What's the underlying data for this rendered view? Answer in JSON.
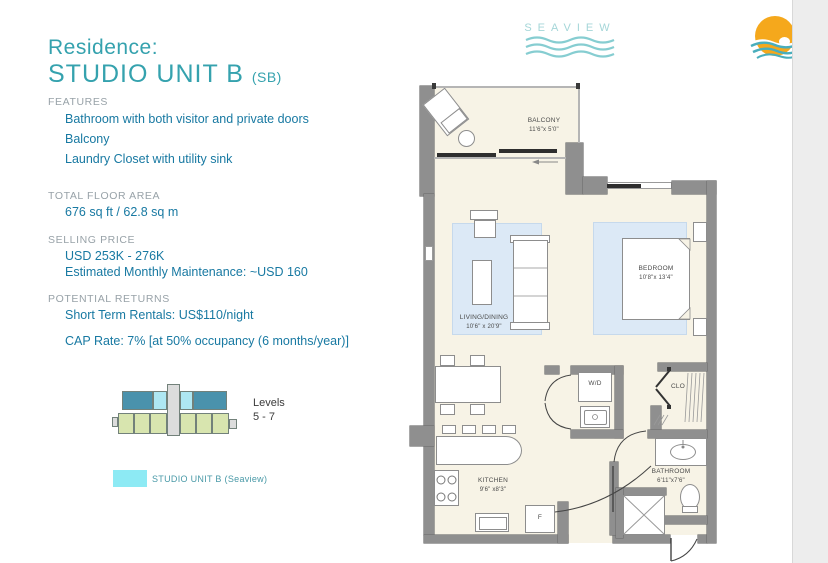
{
  "brand": {
    "wordmark": "SEAVIEW"
  },
  "panel": {
    "residence": "Residence:",
    "unit_name": "STUDIO UNIT B",
    "unit_code": "(SB)",
    "features": {
      "heading": "FEATURES",
      "items": [
        "Bathroom with both visitor and private doors",
        "Balcony",
        "Laundry Closet with utility sink"
      ]
    },
    "floor_area": {
      "heading": "TOTAL FLOOR AREA",
      "value": "676 sq ft / 62.8 sq m"
    },
    "price": {
      "heading": "SELLING PRICE",
      "range": "USD 253K - 276K",
      "maintenance": "Estimated Monthly Maintenance: ~USD 160"
    },
    "returns": {
      "heading": "POTENTIAL RETURNS",
      "rental": "Short Term Rentals: US$110/night",
      "cap_rate": "CAP Rate: 7% [at 50% occupancy (6 months/year)]"
    },
    "levels": {
      "label": "Levels",
      "range": "5 - 7"
    },
    "legend": {
      "label": "STUDIO UNIT B (Seaview)"
    }
  },
  "floorplan": {
    "balcony": {
      "name": "BALCONY",
      "dims": "11'6\"x 5'0\""
    },
    "living": {
      "name": "LIVING/DINING",
      "dims": "10'6\" x 20'9\""
    },
    "bedroom": {
      "name": "BEDROOM",
      "dims": "10'8\"x 13'4\""
    },
    "kitchen": {
      "name": "KITCHEN",
      "dims": "9'6\" x8'3\""
    },
    "bathroom": {
      "name": "BATHROOM",
      "dims": "6'11\"x7'6\""
    },
    "laundry": {
      "label": "W/D"
    },
    "closet": {
      "label": "CLO"
    },
    "fridge": {
      "label": "F"
    }
  },
  "colors": {
    "accent_teal": "#35a2ae",
    "body_teal": "#1879a2",
    "heading_gray": "#98a2a8",
    "legend_swatch": "#8deaf4",
    "building_dark_teal": "#4a92ac",
    "building_cyan": "#aee7f2",
    "building_green": "#d8e5af",
    "logo_orange": "#f5a81c",
    "logo_wave_teal": "#49aebc"
  }
}
